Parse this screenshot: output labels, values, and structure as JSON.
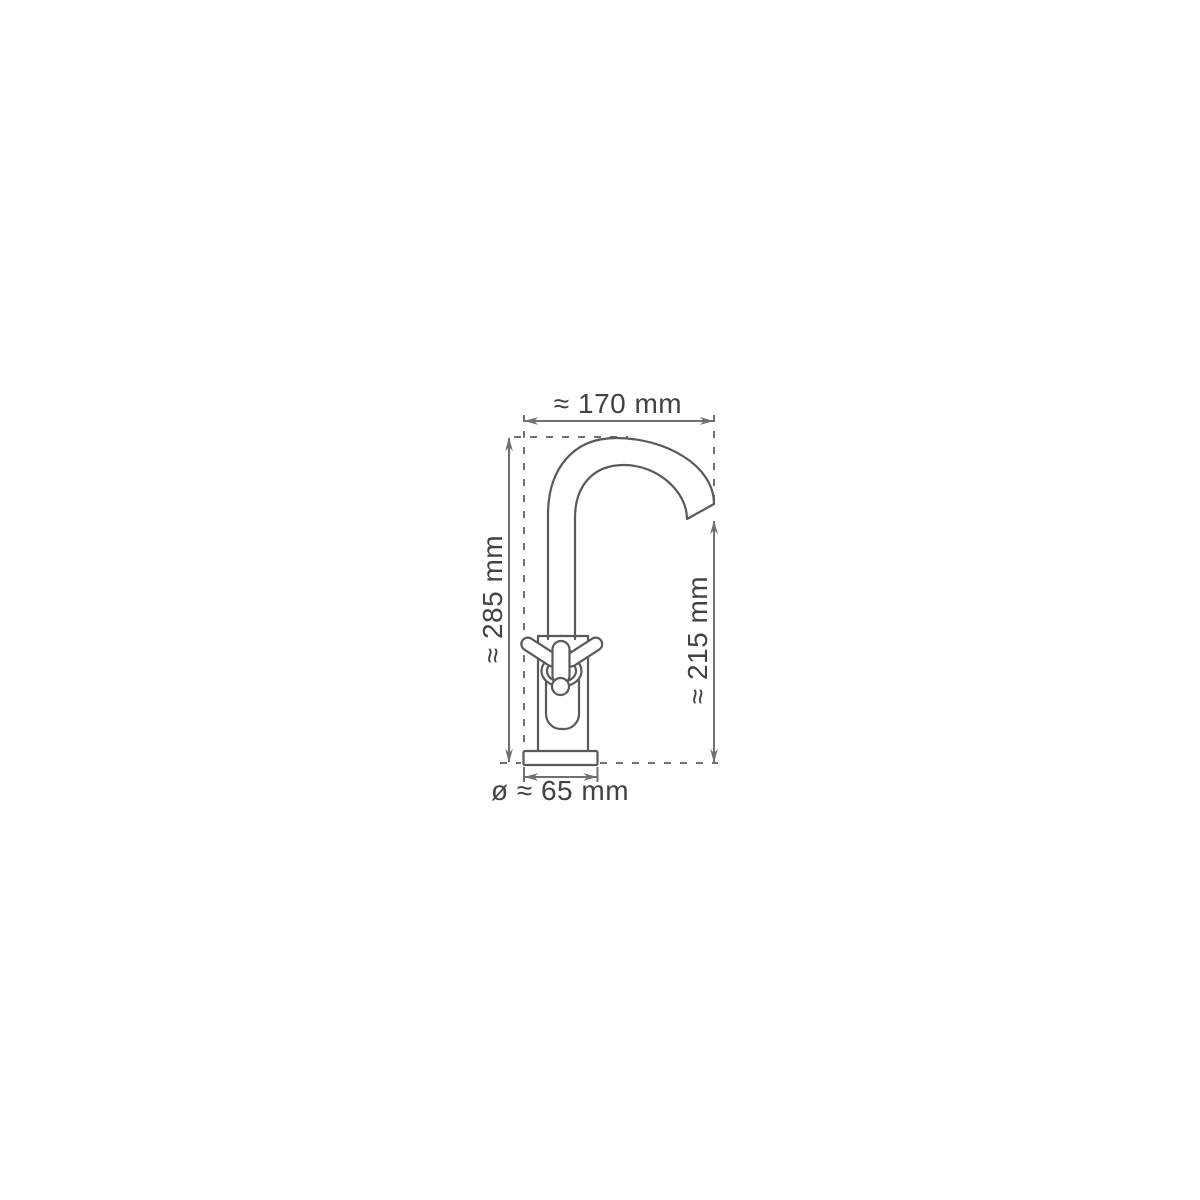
{
  "diagram": {
    "subject": "Basin pillar faucet with cross handle, front elevation technical drawing",
    "dimensions": {
      "width": {
        "label": "≈ 170 mm",
        "value_mm": 170
      },
      "total_height": {
        "label": "≈ 285 mm",
        "value_mm": 285
      },
      "spout_height": {
        "label": "≈ 215 mm",
        "value_mm": 215
      },
      "base_diameter": {
        "label": "ø ≈ 65 mm",
        "value_mm": 65
      }
    },
    "colors": {
      "background": "#ffffff",
      "outline": "#565b60",
      "dimension_line": "#6c7176",
      "label_text": "#3e4348"
    }
  }
}
